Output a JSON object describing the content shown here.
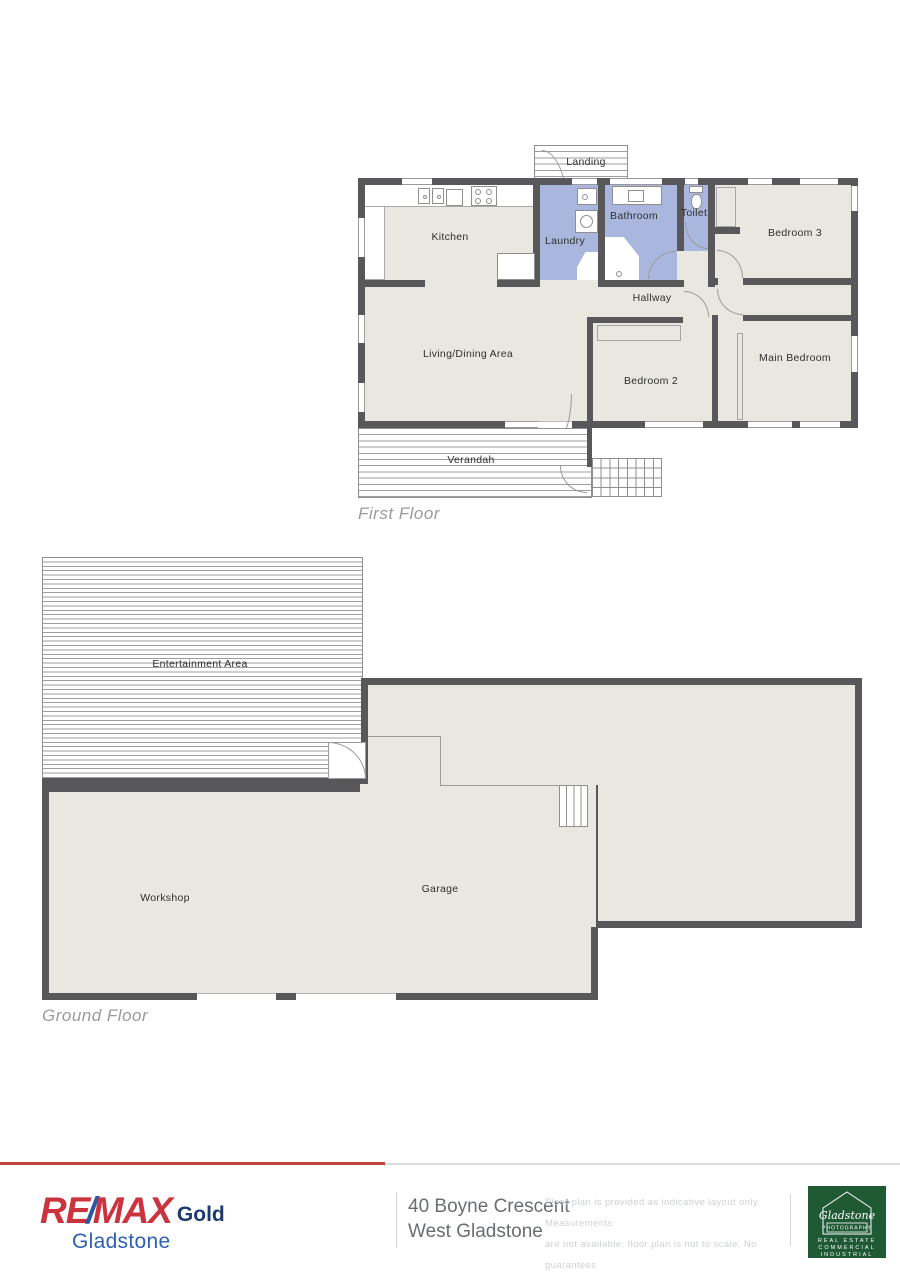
{
  "first_floor": {
    "title": "First Floor",
    "rooms": {
      "landing": "Landing",
      "kitchen": "Kitchen",
      "laundry": "Laundry",
      "bathroom": "Bathroom",
      "toilet": "Toilet",
      "bedroom3": "Bedroom 3",
      "hallway": "Hallway",
      "living": "Living/Dining Area",
      "bedroom2": "Bedroom 2",
      "main_bedroom": "Main Bedroom",
      "verandah": "Verandah"
    }
  },
  "ground_floor": {
    "title": "Ground Floor",
    "rooms": {
      "entertainment": "Entertainment Area",
      "garage": "Garage",
      "workshop": "Workshop"
    }
  },
  "footer": {
    "brand": {
      "re": "RE",
      "slash": "/",
      "max": "MAX",
      "gold": "Gold",
      "office": "Gladstone"
    },
    "address_line1": "40 Boyne Crescent",
    "address_line2": "West Gladstone",
    "disclaimer_line1": "Floor plan is provided as indicative layout only. Measurements",
    "disclaimer_line2": "are not available, floor plan is not to scale. No guarantees",
    "disclaimer_line3": "provided on accuracy. Exterior elements are not in position",
    "photo_logo": {
      "script": "Gladstone",
      "sub": "PHOTOGRAPHY",
      "lines": [
        "REAL ESTATE",
        "COMMERCIAL",
        "INDUSTRIAL"
      ]
    }
  },
  "colors": {
    "wall": "#58585a",
    "room": "#e8e8e0",
    "wet": "#a9b6de",
    "hatch_line": "#9e9e9e",
    "outline": "#8f8f8f",
    "label": "#2f2f2f",
    "floor_title": "#9b9b9b",
    "rule_red": "#c0453c",
    "rule_gray": "#dcdcdc",
    "divider": "#d5d5d5",
    "remax_red": "#cb343c",
    "remax_slash_blue": "#2b56a4",
    "remax_gold_navy": "#1d3a6d",
    "remax_blue": "#2e61b2",
    "address_gray": "#6a6d71",
    "disclaimer_gray": "#ced1d3",
    "photo_green": "#1f5a34"
  }
}
